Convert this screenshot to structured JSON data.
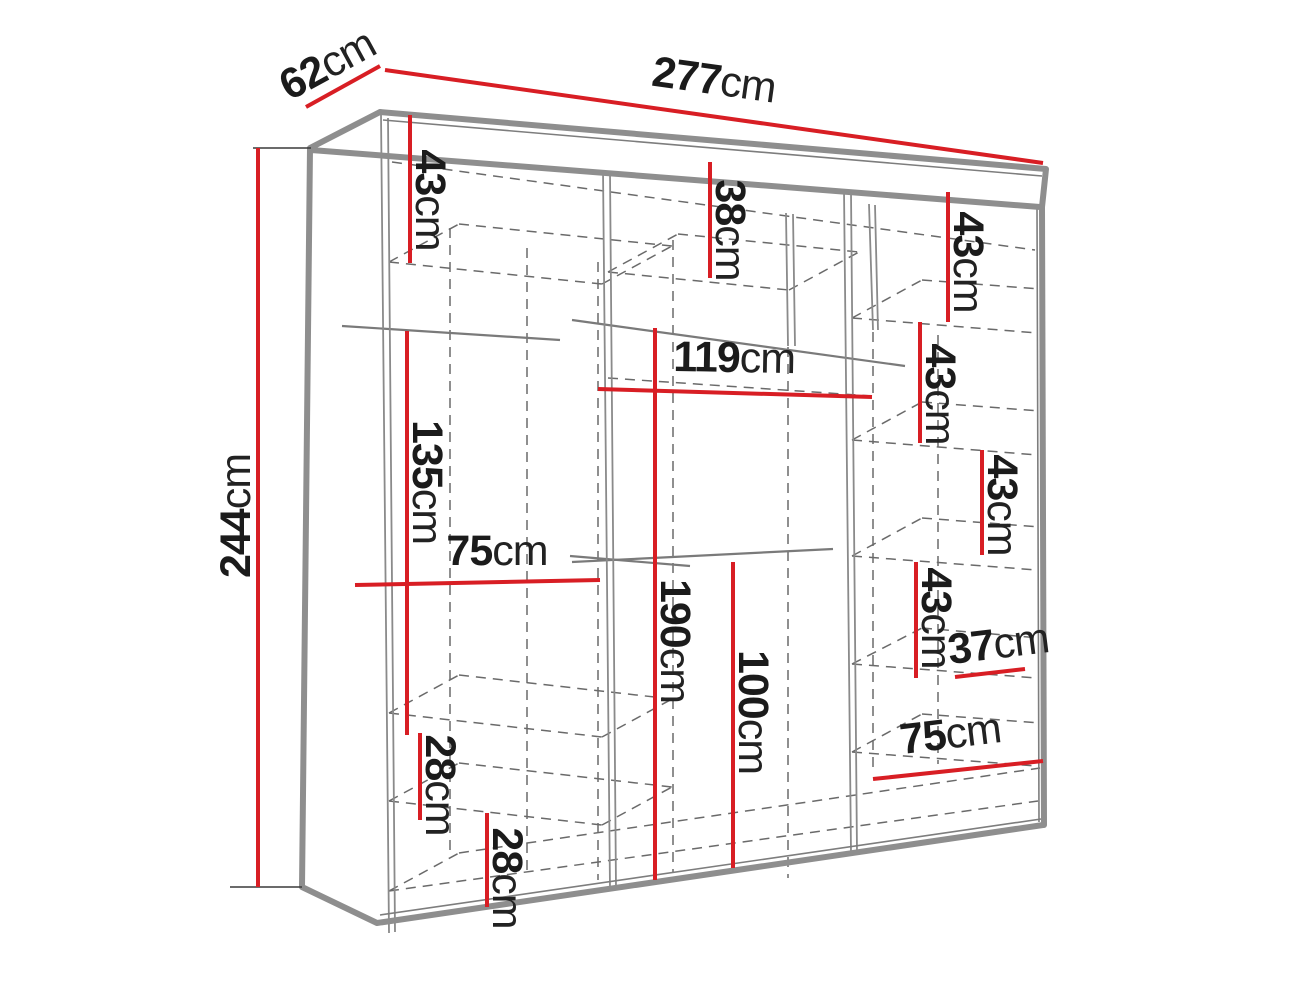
{
  "title": "Wardrobe dimension diagram",
  "unit": "cm",
  "style": {
    "dimension_line_color": "#d81e24",
    "frame_color": "#8e8e8e",
    "dashed_shelf_color": "#6a6a6a",
    "text_color": "#1b1b1b",
    "background": "#ffffff"
  },
  "overall_dimensions": {
    "width_cm": 277,
    "depth_cm": 62,
    "height_cm": 244
  },
  "dimensions": [
    {
      "id": "depth",
      "num": "62",
      "unit": "cm",
      "location": "top-left-slanted-edge"
    },
    {
      "id": "width",
      "num": "277",
      "unit": "cm",
      "location": "top-edge"
    },
    {
      "id": "height",
      "num": "244",
      "unit": "cm",
      "location": "left-edge"
    },
    {
      "id": "left-top-shelf-height",
      "num": "43",
      "unit": "cm",
      "location": "left-column-top"
    },
    {
      "id": "middle-top-cubby-height",
      "num": "38",
      "unit": "cm",
      "location": "middle-column-top"
    },
    {
      "id": "right-compartment-1",
      "num": "43",
      "unit": "cm",
      "location": "right-column"
    },
    {
      "id": "right-compartment-2",
      "num": "43",
      "unit": "cm",
      "location": "right-column"
    },
    {
      "id": "right-compartment-3",
      "num": "43",
      "unit": "cm",
      "location": "right-column"
    },
    {
      "id": "right-compartment-4",
      "num": "43",
      "unit": "cm",
      "location": "right-column"
    },
    {
      "id": "right-cubby-width",
      "num": "37",
      "unit": "cm",
      "location": "right-column"
    },
    {
      "id": "right-section-width",
      "num": "75",
      "unit": "cm",
      "location": "right-column-bottom"
    },
    {
      "id": "middle-section-width",
      "num": "119",
      "unit": "cm",
      "location": "middle-column"
    },
    {
      "id": "left-hanging-height",
      "num": "135",
      "unit": "cm",
      "location": "left-column"
    },
    {
      "id": "left-section-width",
      "num": "75",
      "unit": "cm",
      "location": "left-column"
    },
    {
      "id": "middle-hanging-height",
      "num": "190",
      "unit": "cm",
      "location": "middle-column"
    },
    {
      "id": "middle-lower-height",
      "num": "100",
      "unit": "cm",
      "location": "middle-column"
    },
    {
      "id": "left-shelf-gap-upper",
      "num": "28",
      "unit": "cm",
      "location": "left-column-bottom"
    },
    {
      "id": "left-shelf-gap-lower",
      "num": "28",
      "unit": "cm",
      "location": "left-column-bottom"
    }
  ]
}
